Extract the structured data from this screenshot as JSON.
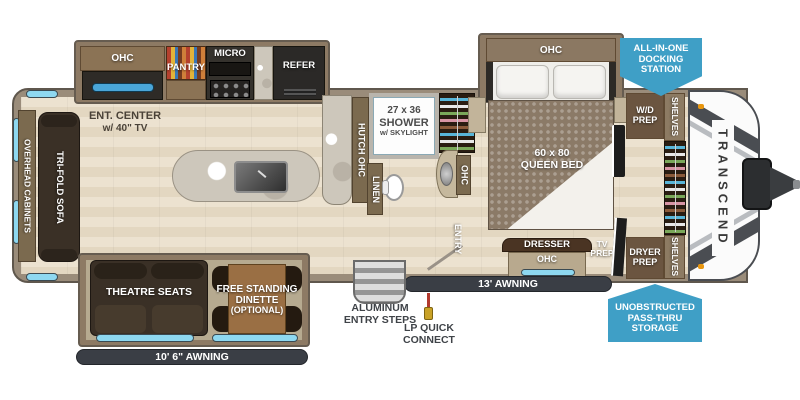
{
  "colors": {
    "badge_blue": "#3f9fc6",
    "awning_dark": "#3a3e45",
    "window_cyan": "#8ed8f0"
  },
  "kitchen": {
    "ohc": "OHC",
    "pantry": "PANTRY",
    "micro": "MICRO",
    "refer": "REFER",
    "ent_center_line1": "ENT. CENTER",
    "ent_center_line2": "w/ 40\" TV"
  },
  "living": {
    "overhead_cabinets": "OVERHEAD CABINETS",
    "sofa": "TRI-FOLD SOFA",
    "theatre": "THEATRE SEATS",
    "dinette_line1": "FREE STANDING",
    "dinette_line2": "DINETTE",
    "dinette_line3": "(OPTIONAL)",
    "awning": "10' 6\" AWNING"
  },
  "bath": {
    "hutch": "HUTCH OHC",
    "shower_line1": "27 x 36",
    "shower_line2": "SHOWER",
    "shower_line3": "w/ SKYLIGHT",
    "linen": "LINEN",
    "ohc": "OHC",
    "entry": "ENTRY"
  },
  "bedroom": {
    "ohc": "OHC",
    "bed_line1": "60 x 80",
    "bed_line2": "QUEEN BED",
    "dresser": "DRESSER",
    "dresser_ohc": "OHC",
    "tv_prep_line1": "TV",
    "tv_prep_line2": "PREP",
    "wd_prep_line1": "W/D",
    "wd_prep_line2": "PREP",
    "dryer_prep_line1": "DRYER",
    "dryer_prep_line2": "PREP",
    "shelves_top": "SHELVES",
    "shelves_bottom": "SHELVES"
  },
  "exterior": {
    "brand": "TRANSCEND",
    "awning13": "13' AWNING",
    "steps_line1": "ALUMINUM",
    "steps_line2": "ENTRY STEPS",
    "lp_line1": "LP QUICK",
    "lp_line2": "CONNECT"
  },
  "badges": {
    "docking_line1": "ALL-IN-ONE",
    "docking_line2": "DOCKING",
    "docking_line3": "STATION",
    "storage_line1": "UNOBSTRUCTED",
    "storage_line2": "PASS-THRU",
    "storage_line3": "STORAGE"
  }
}
